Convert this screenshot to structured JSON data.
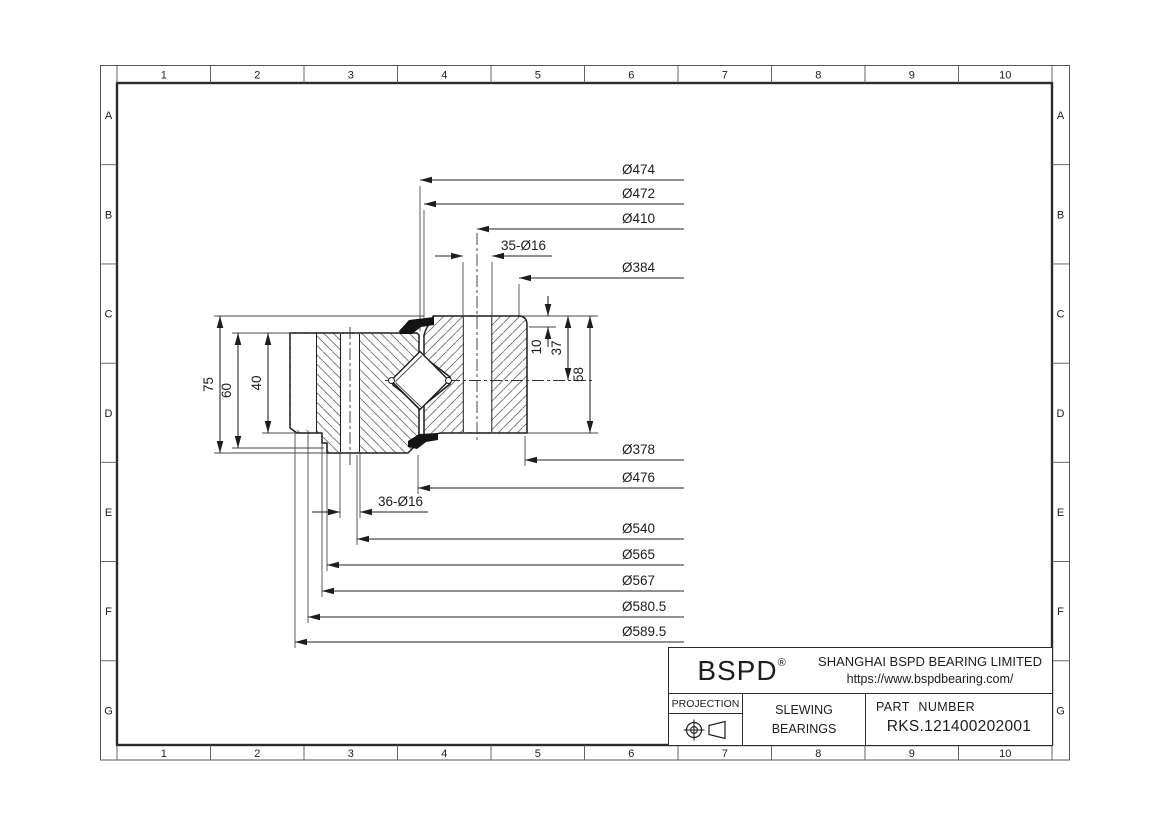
{
  "sheet": {
    "grid": {
      "columns": [
        "1",
        "2",
        "3",
        "4",
        "5",
        "6",
        "7",
        "8",
        "9",
        "10"
      ],
      "rows": [
        "A",
        "B",
        "C",
        "D",
        "E",
        "F",
        "G"
      ]
    }
  },
  "title_block": {
    "logo": "BSPD",
    "logo_reg": "®",
    "company": "SHANGHAI BSPD BEARING LIMITED",
    "website": "https://www.bspdbearing.com/",
    "projection_label": "PROJECTION",
    "product_line1": "SLEWING",
    "product_line2": "BEARINGS",
    "part_number_label": "PART NUMBER",
    "part_number": "RKS.121400202001"
  },
  "dims": {
    "line_end_x": 684,
    "label_x": 622,
    "top": [
      {
        "label": "Ø474",
        "y": 180,
        "tip": 420
      },
      {
        "label": "Ø472",
        "y": 204,
        "tip": 424
      },
      {
        "label": "Ø410",
        "y": 229,
        "tip": 477
      },
      {
        "label": "Ø384",
        "y": 278,
        "tip": 519
      }
    ],
    "top_hole": {
      "label": "35-Ø16",
      "y": 256,
      "x1": 463,
      "x2": 492,
      "line_end": 552,
      "label_x": 501
    },
    "bottom": [
      {
        "label": "Ø378",
        "y": 460,
        "tip": 525
      },
      {
        "label": "Ø476",
        "y": 488,
        "tip": 418
      },
      {
        "label": "Ø540",
        "y": 539,
        "tip": 357
      },
      {
        "label": "Ø565",
        "y": 565,
        "tip": 327
      },
      {
        "label": "Ø567",
        "y": 591,
        "tip": 322
      },
      {
        "label": "Ø580.5",
        "y": 617,
        "tip": 308
      },
      {
        "label": "Ø589.5",
        "y": 642,
        "tip": 295
      }
    ],
    "bottom_hole": {
      "label": "36-Ø16",
      "y": 512,
      "x1": 340,
      "x2": 360,
      "line_end": 428,
      "label_x": 378
    },
    "left": [
      {
        "label": "75",
        "x": 220,
        "y1": 316,
        "y2": 453
      },
      {
        "label": "60",
        "x": 238,
        "y1": 333,
        "y2": 448
      },
      {
        "label": "40",
        "x": 268,
        "y1": 333,
        "y2": 433
      }
    ],
    "right": [
      {
        "label": "10",
        "x": 548,
        "y1": 316,
        "y2": 327,
        "outside": true,
        "label_cy": 347
      },
      {
        "label": "37",
        "x": 568,
        "y1": 316,
        "y2": 380
      },
      {
        "label": "58",
        "x": 590,
        "y1": 316,
        "y2": 433
      }
    ]
  },
  "colors": {
    "outline": "#1d1d1d",
    "thin": "#4a4a4a",
    "hatch": "#6d6d6d",
    "seal_fill": "#141414"
  }
}
